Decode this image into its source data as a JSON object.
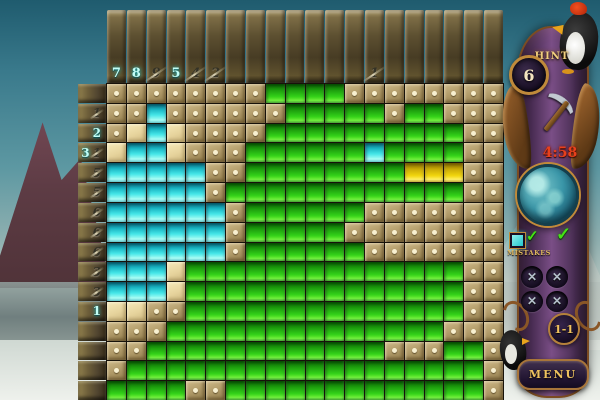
{
  "palette": {
    "fill_cyan": "#45e6e8",
    "fill_green": "#33d119",
    "fill_yellow": "#f1d50d",
    "marked_tan": "#b19b69",
    "unmarked_cream": "#e6d39c",
    "hint_active": "#c2fef6",
    "hint_done": "#343226",
    "gold_text": "#eec25e",
    "timer_red": "#e8401c"
  },
  "top_hints": [
    {
      "v": "7",
      "done": false
    },
    {
      "v": "8",
      "done": false
    },
    {
      "v": "9",
      "done": true
    },
    {
      "v": "5",
      "done": false
    },
    {
      "v": "4",
      "done": true
    },
    {
      "v": "2",
      "done": true
    },
    {
      "v": "",
      "done": false
    },
    {
      "v": "",
      "done": false
    },
    {
      "v": "",
      "done": false
    },
    {
      "v": "",
      "done": false
    },
    {
      "v": "",
      "done": false
    },
    {
      "v": "",
      "done": false
    },
    {
      "v": "",
      "done": false
    },
    {
      "v": "1",
      "done": true
    },
    {
      "v": "",
      "done": false
    },
    {
      "v": "",
      "done": false
    },
    {
      "v": "",
      "done": false
    },
    {
      "v": "",
      "done": false
    },
    {
      "v": "",
      "done": false
    },
    {
      "v": "",
      "done": false
    }
  ],
  "row_hints": [
    [],
    [
      {
        "v": "1",
        "done": true
      }
    ],
    [
      {
        "v": "2",
        "done": false
      }
    ],
    [
      {
        "v": "3",
        "done": false
      },
      {
        "v": "1",
        "done": true
      }
    ],
    [
      {
        "v": "5",
        "done": true
      }
    ],
    [
      {
        "v": "5",
        "done": true
      }
    ],
    [
      {
        "v": "6",
        "done": true
      }
    ],
    [
      {
        "v": "6",
        "done": true
      }
    ],
    [
      {
        "v": "6",
        "done": true
      }
    ],
    [
      {
        "v": "3",
        "done": true
      }
    ],
    [
      {
        "v": "3",
        "done": true
      }
    ],
    [
      {
        "v": "1",
        "done": false
      }
    ],
    [],
    [],
    [],
    []
  ],
  "grid": [
    "ddddddddggggdddddddd",
    "ddcddddddgggggdggddd",
    "dpcpddddggggggggggdd",
    "pccpdddggggggcggggdd",
    "cccccddggggggggyyydd",
    "cccccdggggggggggggdd",
    "ccccccdggggggddddddd",
    "ccccccdgggggdddddddd",
    "ccccccdggggggddddddd",
    "cccpggggggggggggggdd",
    "cccpggggggggggggggdd",
    "ppddggggggggggggggdd",
    "dddggggggggggggggddd",
    "ddggggggggggggdddggd",
    "dggggggggggggggggggd",
    "ggggddgggggggggggggd"
  ],
  "cell_legend": {
    "d": "marked-empty-dot",
    "p": "unmarked",
    "c": "cyan-filled",
    "g": "green-filled",
    "y": "yellow-filled"
  },
  "sidebar": {
    "hint_label": "HINT",
    "hints_remaining": "6",
    "timer": "4:58",
    "check_mark": "✓",
    "mistakes_label": "MISTAKES",
    "mistake_mark": "✕",
    "level": "1-1",
    "menu_label": "MENU"
  }
}
